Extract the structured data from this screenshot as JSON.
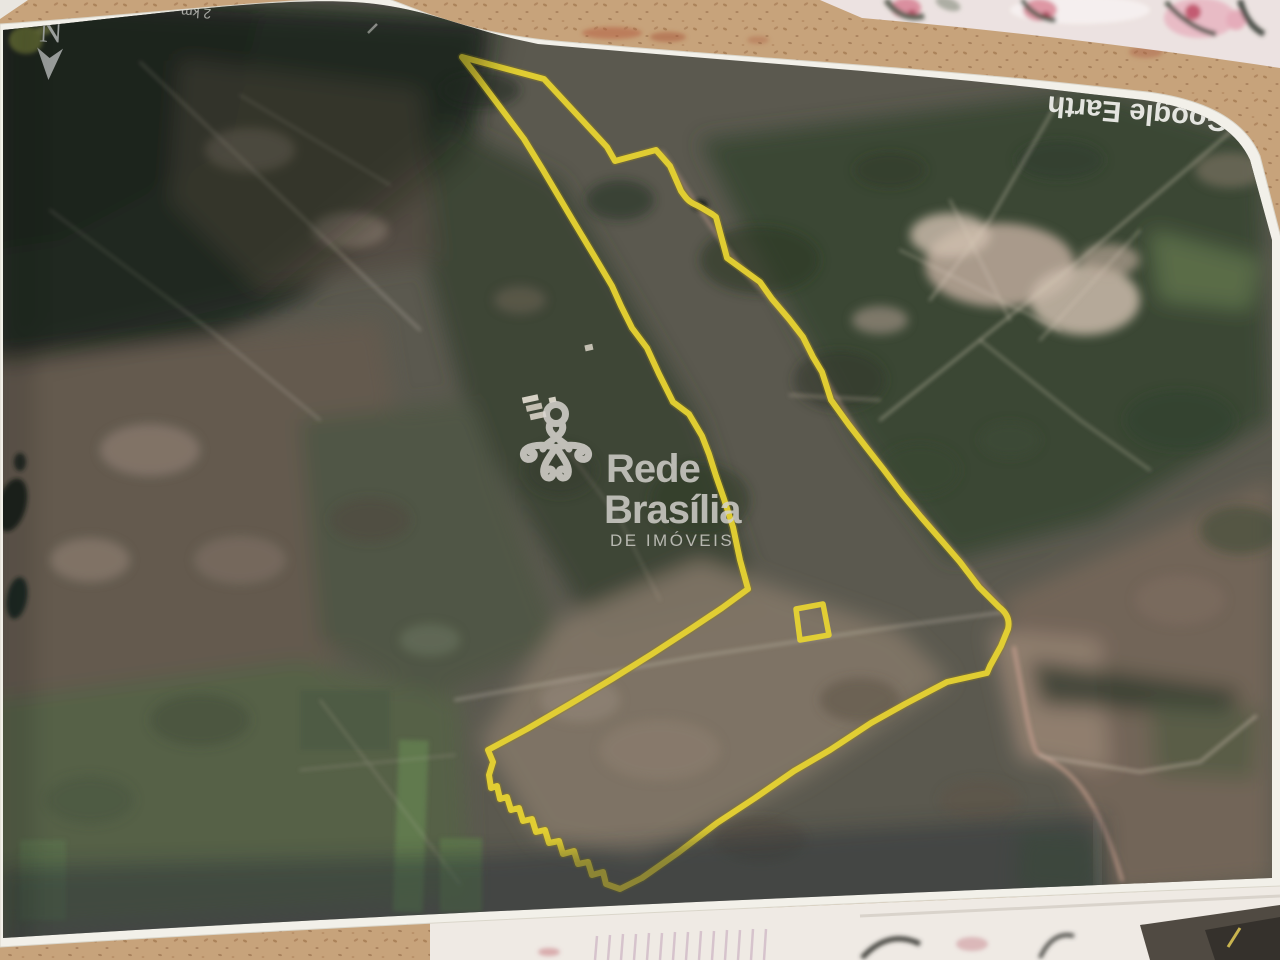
{
  "map": {
    "compass_label": "N",
    "scale_label": "2 km",
    "credit": "Google Earth"
  },
  "watermark": {
    "line1": "Rede",
    "line2": "Brasília",
    "line3": "DE IMÓVEIS"
  },
  "colors": {
    "boundary_yellow": "#e6d22c",
    "boundary_shadow": "#8f7f18",
    "page_white": "#f2f0e9",
    "desk_tan": "#c6a077",
    "fabric_pink": "#ece2e0",
    "map_base": "#56544a",
    "shadow_band": "#232933",
    "watermark_gray": "#d2d0cb",
    "label_white": "#eeeee8"
  }
}
